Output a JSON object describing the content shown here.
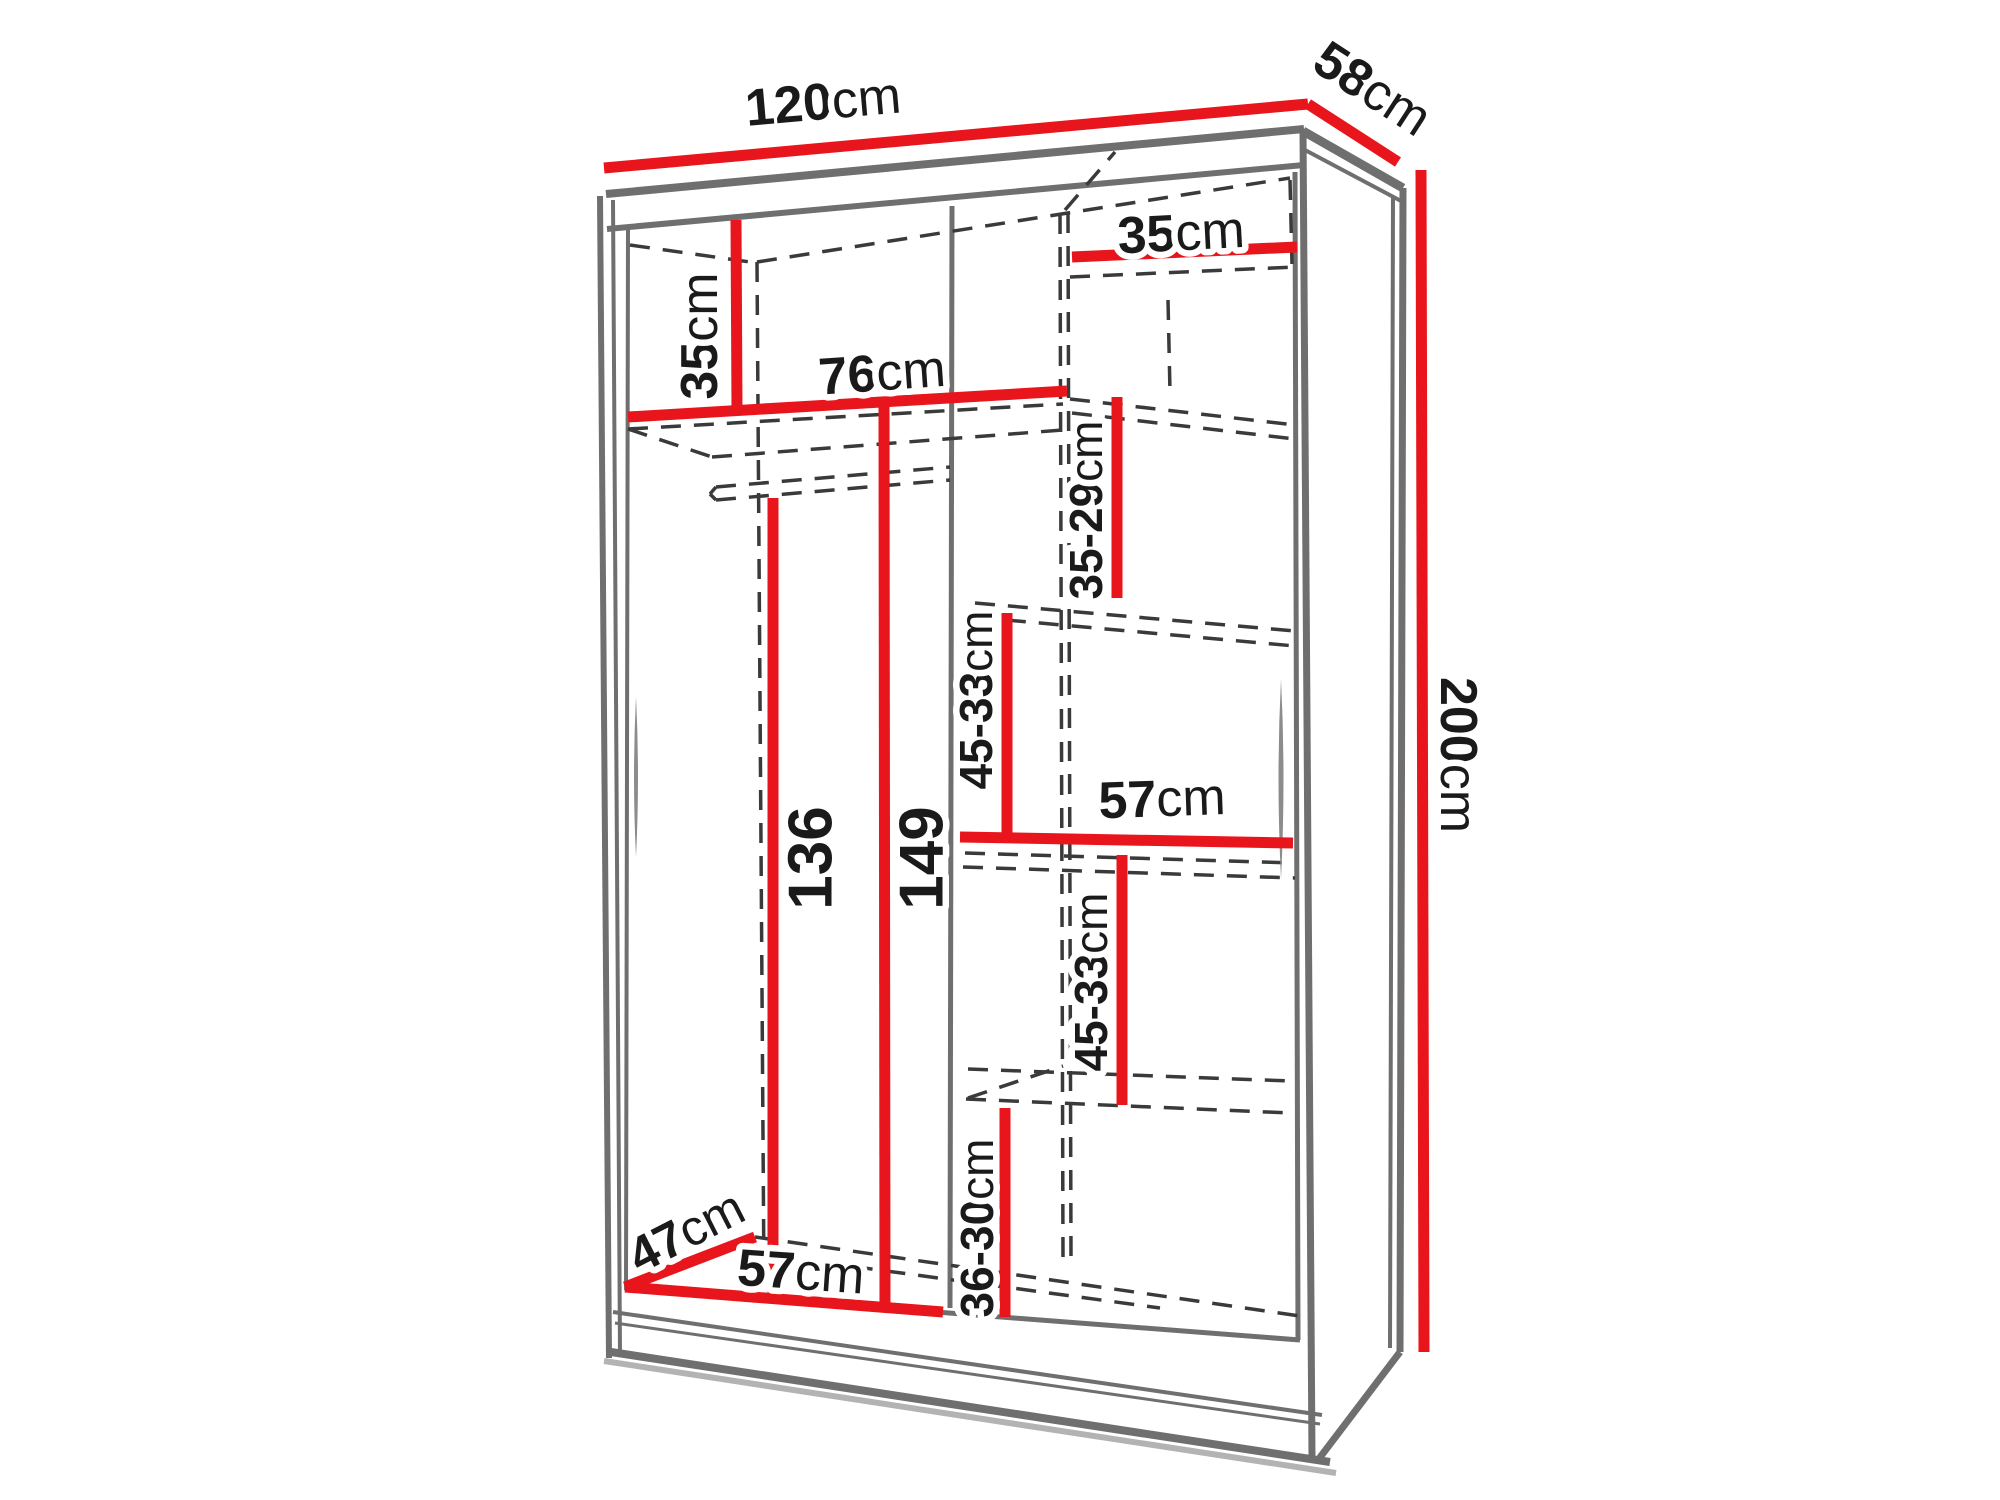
{
  "diagram": {
    "type": "furniture-dimension-diagram",
    "subject": "sliding-door wardrobe with interior shelf dimensions",
    "unit": "cm",
    "overall": {
      "width_cm": "120",
      "depth_cm": "58",
      "height_cm": "200"
    },
    "colors": {
      "dimension_line": "#e8161c",
      "structure_line": "#6f6f6f",
      "hidden_edge_line": "#3a3a3a",
      "label_text": "#1a1a1a",
      "label_halo": "#ffffff",
      "shadow": "#b3b3b3",
      "background": "#ffffff"
    },
    "labels": [
      {
        "name": "dim-width-label",
        "num": "120",
        "unit": "cm",
        "x": 823,
        "y": 101,
        "rot": -5,
        "size": 52
      },
      {
        "name": "dim-depth-label",
        "num": "58",
        "unit": "cm",
        "x": 1373,
        "y": 88,
        "rot": 33,
        "size": 52
      },
      {
        "name": "dim-height-label",
        "num": "200",
        "unit": "cm",
        "x": 1459,
        "y": 755,
        "rot": 90,
        "size": 52
      },
      {
        "name": "dim-left-top-shelf-label",
        "num": "35",
        "unit": "cm",
        "x": 699,
        "y": 336,
        "rot": -90,
        "size": 52
      },
      {
        "name": "dim-right-top-shelf-label",
        "num": "35",
        "unit": "cm",
        "x": 1181,
        "y": 232,
        "rot": -3,
        "size": 52
      },
      {
        "name": "dim-left-section-width-label",
        "num": "76",
        "unit": "cm",
        "x": 882,
        "y": 372,
        "rot": -4,
        "size": 52
      },
      {
        "name": "dim-shelf-gap-1-label",
        "num": "35-29",
        "unit": "cm",
        "x": 1086,
        "y": 510,
        "rot": -90,
        "size": 46
      },
      {
        "name": "dim-shelf-gap-2-label",
        "num": "45-33",
        "unit": "cm",
        "x": 976,
        "y": 700,
        "rot": -90,
        "size": 46
      },
      {
        "name": "dim-right-section-width-label",
        "num": "57",
        "unit": "cm",
        "x": 1162,
        "y": 798,
        "rot": -2,
        "size": 52
      },
      {
        "name": "dim-shelf-gap-3-label",
        "num": "45-33",
        "unit": "cm",
        "x": 1091,
        "y": 982,
        "rot": -90,
        "size": 46
      },
      {
        "name": "dim-shelf-gap-4-label",
        "num": "36-30",
        "unit": "cm",
        "x": 977,
        "y": 1228,
        "rot": -90,
        "size": 46
      },
      {
        "name": "dim-hanging-space-label",
        "num": "136",
        "unit": "",
        "x": 810,
        "y": 858,
        "rot": -90,
        "size": 62
      },
      {
        "name": "dim-interior-height-label",
        "num": "149",
        "unit": "",
        "x": 921,
        "y": 858,
        "rot": -90,
        "size": 62
      },
      {
        "name": "dim-floor-depth-label",
        "num": "47",
        "unit": "cm",
        "x": 686,
        "y": 1231,
        "rot": -27,
        "size": 50
      },
      {
        "name": "dim-floor-width-label",
        "num": "57",
        "unit": "cm",
        "x": 801,
        "y": 1271,
        "rot": 4,
        "size": 52
      }
    ],
    "red_lines": [
      {
        "name": "dim-line-width-120",
        "x1": 604,
        "y1": 168,
        "x2": 1308,
        "y2": 104
      },
      {
        "name": "dim-line-depth-58",
        "x1": 1308,
        "y1": 104,
        "x2": 1398,
        "y2": 162
      },
      {
        "name": "dim-line-height-200",
        "x1": 1421,
        "y1": 170,
        "x2": 1424,
        "y2": 1352
      },
      {
        "name": "dim-line-left-top-shelf-35",
        "x1": 736,
        "y1": 220,
        "x2": 737,
        "y2": 410
      },
      {
        "name": "dim-line-right-top-shelf-35",
        "x1": 1072,
        "y1": 257,
        "x2": 1297,
        "y2": 247
      },
      {
        "name": "dim-line-left-width-76",
        "x1": 628,
        "y1": 417,
        "x2": 1067,
        "y2": 391
      },
      {
        "name": "dim-line-gap-35-29",
        "x1": 1117,
        "y1": 397,
        "x2": 1117,
        "y2": 598
      },
      {
        "name": "dim-line-gap-45-33-upper",
        "x1": 1007,
        "y1": 613,
        "x2": 1007,
        "y2": 837
      },
      {
        "name": "dim-line-right-width-57",
        "x1": 960,
        "y1": 837,
        "x2": 1293,
        "y2": 843
      },
      {
        "name": "dim-line-gap-45-33-lower",
        "x1": 1122,
        "y1": 855,
        "x2": 1122,
        "y2": 1105
      },
      {
        "name": "dim-line-gap-36-30",
        "x1": 1005,
        "y1": 1108,
        "x2": 1005,
        "y2": 1317
      },
      {
        "name": "dim-line-hanging-136",
        "x1": 773,
        "y1": 498,
        "x2": 773,
        "y2": 1300
      },
      {
        "name": "dim-line-interior-149",
        "x1": 884,
        "y1": 402,
        "x2": 885,
        "y2": 1310
      },
      {
        "name": "dim-line-floor-depth-47",
        "x1": 625,
        "y1": 1287,
        "x2": 755,
        "y2": 1237
      },
      {
        "name": "dim-line-floor-width-57",
        "x1": 625,
        "y1": 1287,
        "x2": 943,
        "y2": 1312
      }
    ],
    "gray_lines": [
      {
        "name": "top-band-upper-edge",
        "x1": 606,
        "y1": 194,
        "x2": 1304,
        "y2": 129,
        "w": 8
      },
      {
        "name": "top-band-lower-edge",
        "x1": 607,
        "y1": 229,
        "x2": 1304,
        "y2": 165,
        "w": 6
      },
      {
        "name": "left-edge-outer",
        "x1": 600,
        "y1": 196,
        "x2": 609,
        "y2": 1358,
        "w": 6
      },
      {
        "name": "left-edge-mid",
        "x1": 613,
        "y1": 200,
        "x2": 620,
        "y2": 1356,
        "w": 4
      },
      {
        "name": "left-edge-inner",
        "x1": 628,
        "y1": 226,
        "x2": 626,
        "y2": 1290,
        "w": 4
      },
      {
        "name": "center-divider",
        "x1": 952,
        "y1": 206,
        "x2": 950,
        "y2": 1308,
        "w": 5
      },
      {
        "name": "right-edge-inner",
        "x1": 1295,
        "y1": 172,
        "x2": 1298,
        "y2": 1340,
        "w": 5
      },
      {
        "name": "right-front-edge",
        "x1": 1303,
        "y1": 131,
        "x2": 1312,
        "y2": 1458,
        "w": 7
      },
      {
        "name": "side-top-edge",
        "x1": 1303,
        "y1": 131,
        "x2": 1403,
        "y2": 188,
        "w": 9
      },
      {
        "name": "side-top-inner-edge",
        "x1": 1305,
        "y1": 150,
        "x2": 1401,
        "y2": 201,
        "w": 4
      },
      {
        "name": "side-back-outer-edge",
        "x1": 1403,
        "y1": 188,
        "x2": 1400,
        "y2": 1352,
        "w": 7
      },
      {
        "name": "side-back-inner-edge",
        "x1": 1393,
        "y1": 196,
        "x2": 1390,
        "y2": 1348,
        "w": 4
      },
      {
        "name": "side-bottom-edge",
        "x1": 1400,
        "y1": 1352,
        "x2": 1318,
        "y2": 1460,
        "w": 7
      },
      {
        "name": "floor-front-edge",
        "x1": 625,
        "y1": 1288,
        "x2": 1300,
        "y2": 1340,
        "w": 5
      },
      {
        "name": "plinth-top-edge-a",
        "x1": 613,
        "y1": 1312,
        "x2": 1322,
        "y2": 1415,
        "w": 4
      },
      {
        "name": "plinth-top-edge-b",
        "x1": 615,
        "y1": 1323,
        "x2": 1320,
        "y2": 1424,
        "w": 3
      },
      {
        "name": "plinth-bottom-edge",
        "x1": 611,
        "y1": 1352,
        "x2": 1330,
        "y2": 1462,
        "w": 8
      },
      {
        "name": "plinth-shadow",
        "x1": 604,
        "y1": 1361,
        "x2": 1336,
        "y2": 1473,
        "w": 6,
        "color": "#b3b3b3"
      }
    ],
    "dashed_lines": [
      {
        "name": "ceiling-left-depth-edge",
        "x1": 630,
        "y1": 245,
        "x2": 757,
        "y2": 263
      },
      {
        "name": "ceiling-back-edge",
        "x1": 757,
        "y1": 262,
        "x2": 1290,
        "y2": 178
      },
      {
        "name": "back-top-right-depth-edge",
        "x1": 1065,
        "y1": 210,
        "x2": 1115,
        "y2": 152
      },
      {
        "name": "back-left-corner-edge",
        "x1": 757,
        "y1": 262,
        "x2": 764,
        "y2": 1282
      },
      {
        "name": "divider-back-edge-a",
        "x1": 1060,
        "y1": 214,
        "x2": 1063,
        "y2": 1258
      },
      {
        "name": "divider-back-edge-b",
        "x1": 1068,
        "y1": 213,
        "x2": 1071,
        "y2": 1256
      },
      {
        "name": "back-right-corner-segment",
        "x1": 1290,
        "y1": 180,
        "x2": 1292,
        "y2": 264
      },
      {
        "name": "back-mid-segment",
        "x1": 1168,
        "y1": 300,
        "x2": 1170,
        "y2": 392
      },
      {
        "name": "left-shelf-underside-edge",
        "x1": 628,
        "y1": 429,
        "x2": 1063,
        "y2": 404
      },
      {
        "name": "left-shelf-depth-edge",
        "x1": 628,
        "y1": 429,
        "x2": 712,
        "y2": 457
      },
      {
        "name": "left-shelf-back-edge",
        "x1": 712,
        "y1": 457,
        "x2": 1063,
        "y2": 430
      },
      {
        "name": "hanging-rail-top",
        "x1": 716,
        "y1": 487,
        "x2": 950,
        "y2": 467
      },
      {
        "name": "hanging-rail-bottom",
        "x1": 716,
        "y1": 500,
        "x2": 950,
        "y2": 480
      },
      {
        "name": "hanging-rail-cap-a",
        "x1": 710,
        "y1": 494,
        "x2": 716,
        "y2": 487
      },
      {
        "name": "hanging-rail-cap-b",
        "x1": 710,
        "y1": 494,
        "x2": 716,
        "y2": 500
      },
      {
        "name": "shelf-a-back-edge",
        "x1": 1070,
        "y1": 277,
        "x2": 1295,
        "y2": 267
      },
      {
        "name": "shelf-b-front-edge",
        "x1": 1070,
        "y1": 399,
        "x2": 1295,
        "y2": 425
      },
      {
        "name": "shelf-b-back-edge",
        "x1": 1072,
        "y1": 413,
        "x2": 1295,
        "y2": 439
      },
      {
        "name": "shelf-c-front-edge",
        "x1": 975,
        "y1": 603,
        "x2": 1295,
        "y2": 631
      },
      {
        "name": "shelf-c-back-edge",
        "x1": 973,
        "y1": 617,
        "x2": 1295,
        "y2": 646
      },
      {
        "name": "shelf-d-front-edge",
        "x1": 965,
        "y1": 853,
        "x2": 1295,
        "y2": 863
      },
      {
        "name": "shelf-d-back-edge",
        "x1": 963,
        "y1": 867,
        "x2": 1295,
        "y2": 878
      },
      {
        "name": "shelf-e-front-edge",
        "x1": 968,
        "y1": 1069,
        "x2": 1290,
        "y2": 1081
      },
      {
        "name": "shelf-e-back-edge",
        "x1": 966,
        "y1": 1099,
        "x2": 1290,
        "y2": 1113
      },
      {
        "name": "shelf-e-depth-edge",
        "x1": 968,
        "y1": 1098,
        "x2": 1063,
        "y2": 1066
      },
      {
        "name": "floor-back-edge",
        "x1": 755,
        "y1": 1237,
        "x2": 1300,
        "y2": 1316
      },
      {
        "name": "floor-back-edge-b",
        "x1": 820,
        "y1": 1262,
        "x2": 1160,
        "y2": 1308
      }
    ],
    "lens_marks": [
      {
        "name": "left-panel-reflection",
        "cx": 636,
        "cy": 777,
        "half": 80,
        "w": 4
      },
      {
        "name": "right-panel-reflection",
        "cx": 1281,
        "cy": 779,
        "half": 100,
        "w": 5
      }
    ]
  }
}
